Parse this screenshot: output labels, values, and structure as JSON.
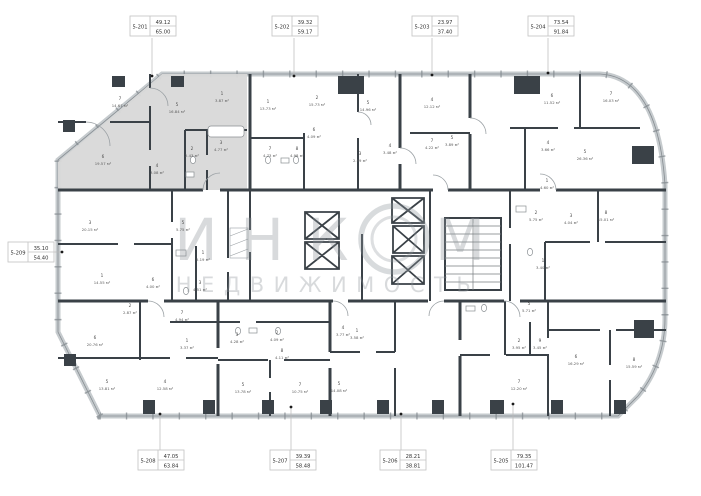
{
  "plan": {
    "watermark": {
      "line1": "ИНКОМ",
      "line2": "НЕДВИЖИМОСТЬ"
    },
    "area_suffix": "м²",
    "colors": {
      "wall": "#3a4147",
      "highlight_unit": "#d8d8d8",
      "watermark": "#8e959a",
      "callout_border": "#c2c2c2"
    },
    "units": [
      {
        "id": "5-201",
        "v1": "49.12",
        "v2": "65.00",
        "box": [
          130,
          16
        ],
        "leader": [
          152,
          38,
          152,
          76
        ]
      },
      {
        "id": "5-202",
        "v1": "39.32",
        "v2": "59.17",
        "box": [
          272,
          16
        ],
        "leader": [
          294,
          38,
          294,
          76
        ]
      },
      {
        "id": "5-203",
        "v1": "23.97",
        "v2": "37.40",
        "box": [
          412,
          16
        ],
        "leader": [
          432,
          38,
          432,
          75
        ]
      },
      {
        "id": "5-204",
        "v1": "73.54",
        "v2": "91.84",
        "box": [
          528,
          16
        ],
        "leader": [
          548,
          38,
          548,
          73
        ]
      },
      {
        "id": "5-209",
        "v1": "35.10",
        "v2": "54.40",
        "box": [
          8,
          242
        ],
        "leader": [
          54,
          252,
          62,
          252
        ]
      },
      {
        "id": "5-208",
        "v1": "47.05",
        "v2": "63.84",
        "box": [
          138,
          450
        ],
        "leader": [
          160,
          450,
          160,
          414
        ]
      },
      {
        "id": "5-207",
        "v1": "39.39",
        "v2": "58.48",
        "box": [
          270,
          450
        ],
        "leader": [
          291,
          450,
          291,
          407
        ]
      },
      {
        "id": "5-206",
        "v1": "28.21",
        "v2": "38.81",
        "box": [
          380,
          450
        ],
        "leader": [
          401,
          450,
          401,
          414
        ]
      },
      {
        "id": "5-205",
        "v1": "79.35",
        "v2": "101.47",
        "box": [
          491,
          450
        ],
        "leader": [
          513,
          450,
          513,
          404
        ]
      }
    ],
    "rooms": [
      [
        "7",
        "14.67",
        120,
        100,
        1
      ],
      [
        "5",
        "16.84",
        177,
        106,
        1
      ],
      [
        "1",
        "3.87",
        222,
        95,
        1
      ],
      [
        "6",
        "19.57",
        103,
        158,
        1
      ],
      [
        "2",
        "2.43",
        192,
        150,
        1
      ],
      [
        "3",
        "4.77",
        221,
        144,
        1
      ],
      [
        "4",
        "3.08",
        157,
        167,
        1
      ],
      [
        "1",
        "13.73",
        268,
        103,
        0
      ],
      [
        "2",
        "15.73",
        317,
        99,
        0
      ],
      [
        "6",
        "4.09",
        314,
        131,
        0
      ],
      [
        "7",
        "4.73",
        270,
        150,
        0
      ],
      [
        "8",
        "4.98",
        297,
        150,
        0
      ],
      [
        "3",
        "2.99",
        360,
        155,
        0
      ],
      [
        "5",
        "14.96",
        368,
        104,
        0
      ],
      [
        "4",
        "3.48",
        390,
        147,
        0
      ],
      [
        "4",
        "12.12",
        432,
        101,
        0
      ],
      [
        "7",
        "4.22",
        432,
        142,
        0
      ],
      [
        "5",
        "3.89",
        452,
        139,
        0
      ],
      [
        "6",
        "11.52",
        552,
        97,
        0
      ],
      [
        "7",
        "16.03",
        611,
        95,
        0
      ],
      [
        "4",
        "3.66",
        548,
        144,
        0
      ],
      [
        "5",
        "26.36",
        585,
        153,
        0
      ],
      [
        "1",
        "4.60",
        547,
        182,
        0
      ],
      [
        "2",
        "5.75",
        536,
        214,
        0
      ],
      [
        "3",
        "4.04",
        571,
        217,
        0
      ],
      [
        "8",
        "15.01",
        606,
        214,
        0
      ],
      [
        "1",
        "3.40",
        543,
        262,
        0
      ],
      [
        "5",
        "5.71",
        529,
        305,
        0
      ],
      [
        "3",
        "20.15",
        90,
        224,
        0
      ],
      [
        "1",
        "14.55",
        102,
        277,
        0
      ],
      [
        "6",
        "4.00",
        153,
        281,
        0
      ],
      [
        "2",
        "2.87",
        130,
        307,
        0
      ],
      [
        "5",
        "5.75",
        183,
        224,
        0
      ],
      [
        "1",
        "5.19",
        203,
        254,
        0
      ],
      [
        "3",
        "4.51",
        200,
        284,
        0
      ],
      [
        "6",
        "20.76",
        95,
        339,
        0
      ],
      [
        "5",
        "13.81",
        107,
        383,
        0
      ],
      [
        "4",
        "12.58",
        165,
        383,
        0
      ],
      [
        "1",
        "3.37",
        187,
        342,
        0
      ],
      [
        "7",
        "4.94",
        182,
        314,
        0
      ],
      [
        "3",
        "4.28",
        237,
        336,
        0
      ],
      [
        "2",
        "4.09",
        277,
        334,
        0
      ],
      [
        "8",
        "4.11",
        282,
        352,
        0
      ],
      [
        "5",
        "13.78",
        243,
        386,
        0
      ],
      [
        "7",
        "10.75",
        300,
        386,
        0
      ],
      [
        "4",
        "3.77",
        343,
        329,
        0
      ],
      [
        "1",
        "3.58",
        357,
        332,
        0
      ],
      [
        "5",
        "14.08",
        339,
        385,
        0
      ],
      [
        "2",
        "3.95",
        519,
        342,
        0
      ],
      [
        "9",
        "3.45",
        540,
        342,
        0
      ],
      [
        "6",
        "16.29",
        576,
        358,
        0
      ],
      [
        "8",
        "15.59",
        634,
        361,
        0
      ],
      [
        "7",
        "12.20",
        519,
        383,
        0
      ]
    ]
  }
}
